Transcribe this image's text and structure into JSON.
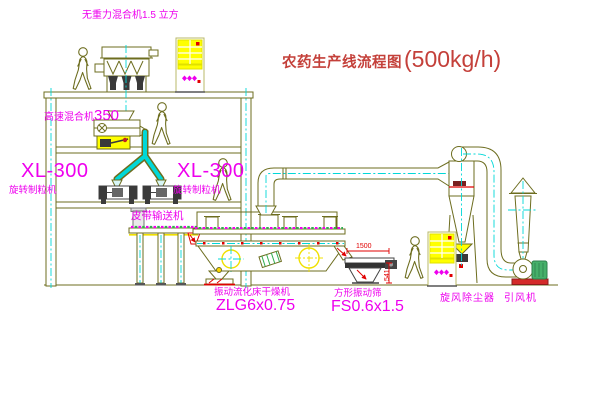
{
  "diagram": {
    "title": "农药生产线流程图",
    "capacity": "(500kg/h)"
  },
  "labels": {
    "no_gravity_mixer": "无重力混合机1.5 立方",
    "high_speed_mixer": "高速混合机",
    "high_speed_mixer_model": "350",
    "granulator_model_left": "XL-300",
    "granulator_name_left": "旋转制粒机",
    "granulator_model_right": "XL-300",
    "granulator_name_right": "旋转制粒机",
    "belt_conveyor": "皮带输送机",
    "dryer_name": "振动流化床干燥机",
    "dryer_model": "ZLG6x0.75",
    "screen_name": "方形振动筛",
    "screen_model": "FS0.6x1.5",
    "cyclone": "旋风除尘器",
    "fan": "引风机"
  },
  "dimensions": {
    "screen_length_mm": "1500",
    "screen_outlet_height_mm": "541"
  },
  "colors": {
    "line_olive": "#6d6d1f",
    "centerline_cyan": "#00d8d8",
    "label_magenta": "#ee00ee",
    "dimension_red": "#e00000",
    "title_red": "#c4403a",
    "panel_yellow": "#ffff00",
    "hatch_green": "#2fae4e"
  },
  "icons": {
    "person": "walking-person-icon",
    "control_cabinet": "control-cabinet-icon",
    "center_mark": "center-mark-icon"
  }
}
